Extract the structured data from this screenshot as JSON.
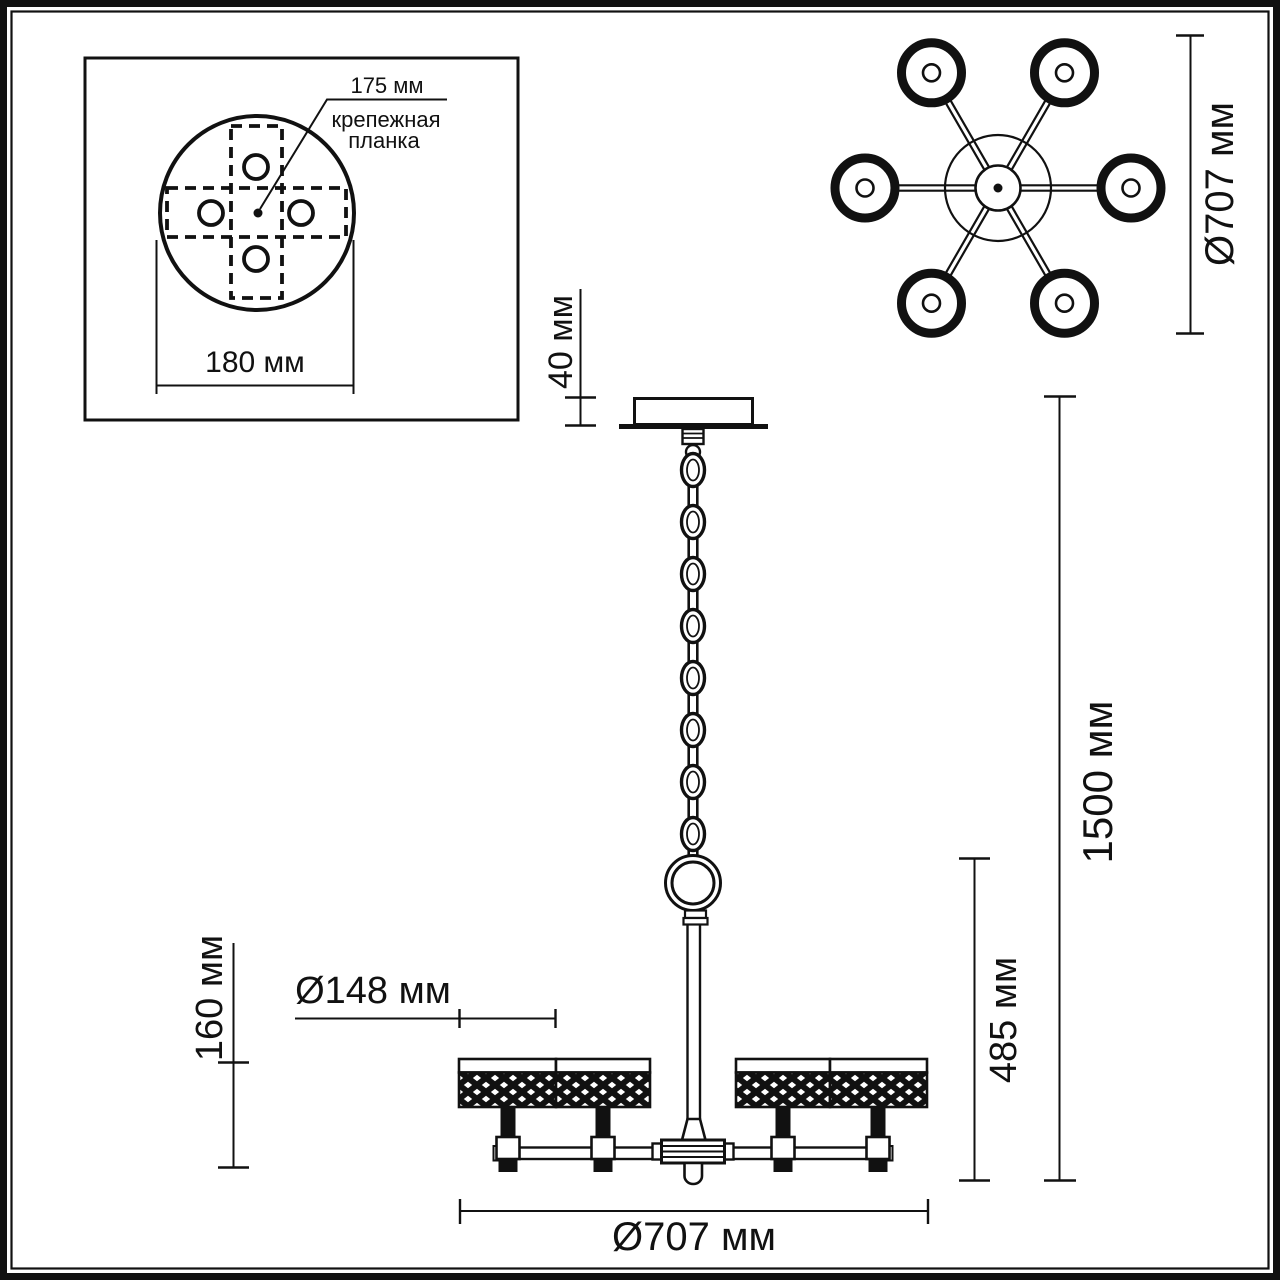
{
  "drawing": {
    "kind": "chandelier dimensional drawing",
    "units": "мм"
  },
  "inset": {
    "callout_value": "175 мм",
    "callout_name_line1": "крепежная",
    "callout_name_line2": "планка",
    "width_dim": "180 мм"
  },
  "top_view": {
    "diameter_dim": "Ø707 мм"
  },
  "side_view": {
    "canopy_height_dim": "40 мм",
    "overall_height_dim": "1500 мм",
    "fixture_height_dim": "485 мм",
    "shade_height_dim": "160 мм",
    "shade_diameter_dim": "Ø148 мм",
    "overall_diameter_dim": "Ø707 мм"
  },
  "colors": {
    "ink": "#111111",
    "paper": "#ffffff"
  }
}
